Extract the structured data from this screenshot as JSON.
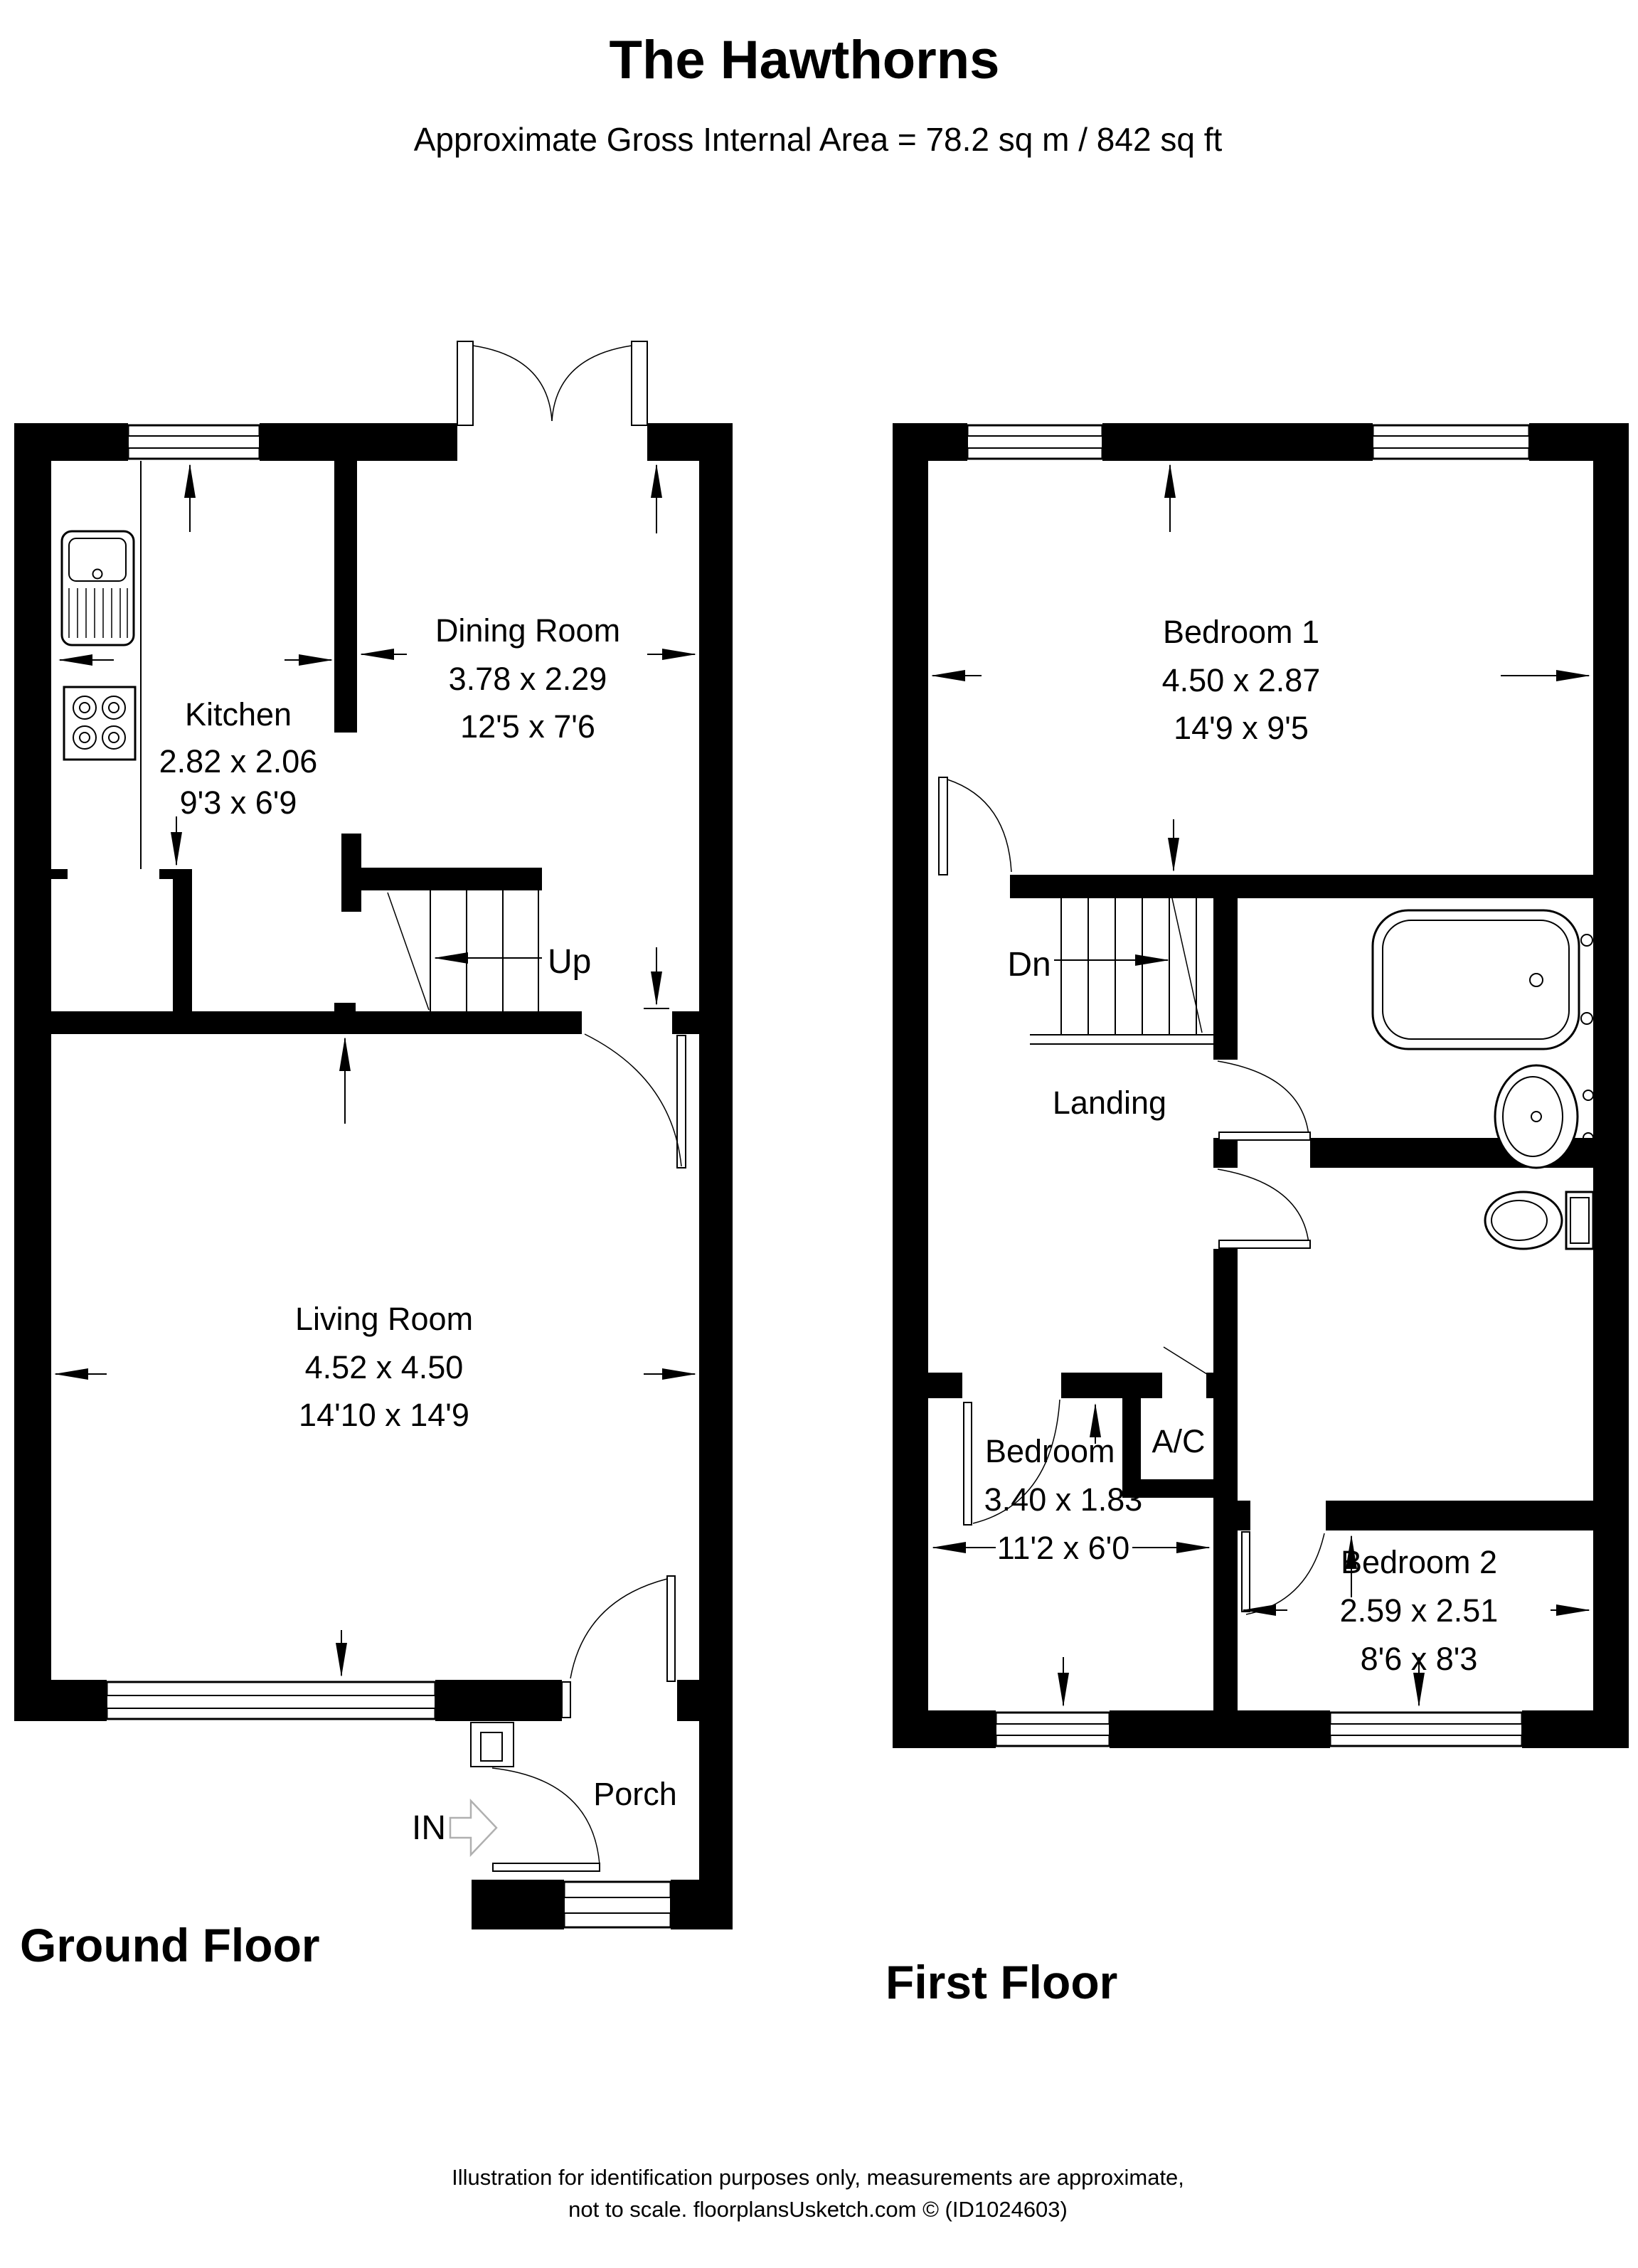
{
  "title": "The Hawthorns",
  "subtitle": "Approximate Gross Internal Area = 78.2 sq m / 842 sq ft",
  "ground_floor": {
    "label": "Ground Floor",
    "stairs_label": "Up",
    "entrance_label": "IN",
    "rooms": {
      "kitchen": {
        "name": "Kitchen",
        "metric": "2.82 x 2.06",
        "imperial": "9'3 x 6'9"
      },
      "dining_room": {
        "name": "Dining Room",
        "metric": "3.78 x 2.29",
        "imperial": "12'5 x 7'6"
      },
      "living_room": {
        "name": "Living Room",
        "metric": "4.52 x 4.50",
        "imperial": "14'10 x 14'9"
      },
      "porch": {
        "name": "Porch"
      }
    }
  },
  "first_floor": {
    "label": "First Floor",
    "stairs_label": "Dn",
    "rooms": {
      "bedroom_1": {
        "name": "Bedroom 1",
        "metric": "4.50 x 2.87",
        "imperial": "14'9 x 9'5"
      },
      "bedroom_2": {
        "name": "Bedroom 2",
        "metric": "2.59 x 2.51",
        "imperial": "8'6 x 8'3"
      },
      "bedroom_3": {
        "name": "Bedroom 3",
        "metric": "3.40 x 1.83",
        "imperial": "11'2 x 6'0"
      },
      "landing": {
        "name": "Landing"
      },
      "airing_cupboard": {
        "name": "A/C"
      }
    }
  },
  "footer": {
    "line1": "Illustration for identification purposes only, measurements are approximate,",
    "line2": "not to scale. floorplansUsketch.com © (ID1024603)"
  },
  "colors": {
    "wall": "#000000",
    "background": "#ffffff",
    "entrance_arrow": "#b0b0b0"
  }
}
